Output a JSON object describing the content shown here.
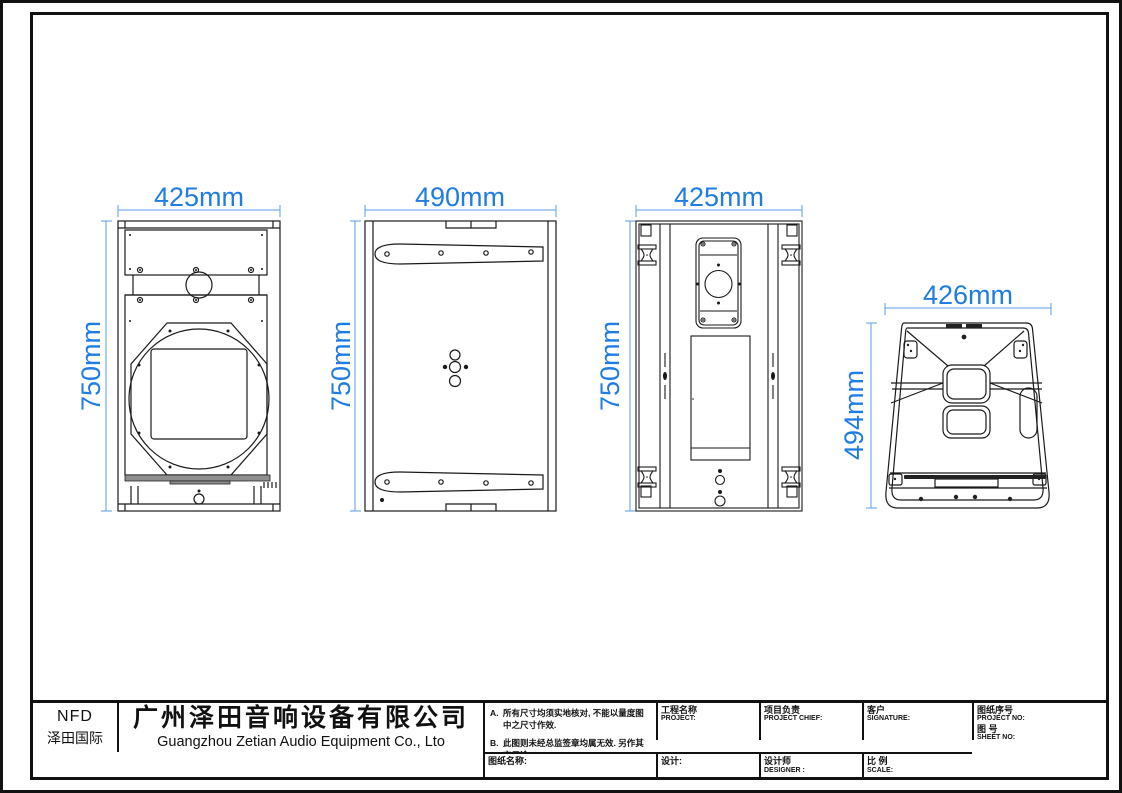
{
  "sheet": {
    "background": "#ffffff",
    "line_color": "#1a1a1a",
    "accent_blue": "#1f7ce4"
  },
  "views": [
    {
      "name": "front-view",
      "width_label": "425mm",
      "height_label": "750mm"
    },
    {
      "name": "side-view",
      "width_label": "490mm",
      "height_label": "750mm"
    },
    {
      "name": "rear-view",
      "width_label": "425mm",
      "height_label": "750mm"
    },
    {
      "name": "top-view",
      "width_label": "426mm",
      "height_label": "494mm"
    }
  ],
  "title_block": {
    "logo": {
      "brand": "NFD",
      "brand_cn": "泽田国际"
    },
    "company": {
      "name_cn": "广州泽田音响设备有限公司",
      "name_en": "Guangzhou Zetian Audio Equipment Co., Lto"
    },
    "fields": {
      "project": {
        "cn": "工程名称",
        "en": "PROJECT:"
      },
      "project_chief": {
        "cn": "项目负责",
        "en": "PROJECT CHIEF:"
      },
      "customer": {
        "cn": "客户",
        "en": "SIGNATURE:"
      },
      "project_no": {
        "cn": "图纸序号",
        "en": "PROJECT NO:"
      },
      "sheet_no": {
        "cn": "图  号",
        "en": "SHEET NO:"
      },
      "drawing_name": {
        "cn": "图纸名称:"
      },
      "design": {
        "cn": "设计:"
      },
      "designer": {
        "cn": "设计师",
        "en": "DESIGNER :"
      },
      "scale": {
        "cn": "比 例",
        "en": "SCALE:"
      }
    },
    "notes": [
      {
        "marker": "A.",
        "text": "所有尺寸均须实地核对, 不能以量度图中之尺寸作效."
      },
      {
        "marker": "B.",
        "text": "此图则未经总监签章均属无效. 另作其它用途."
      }
    ]
  }
}
